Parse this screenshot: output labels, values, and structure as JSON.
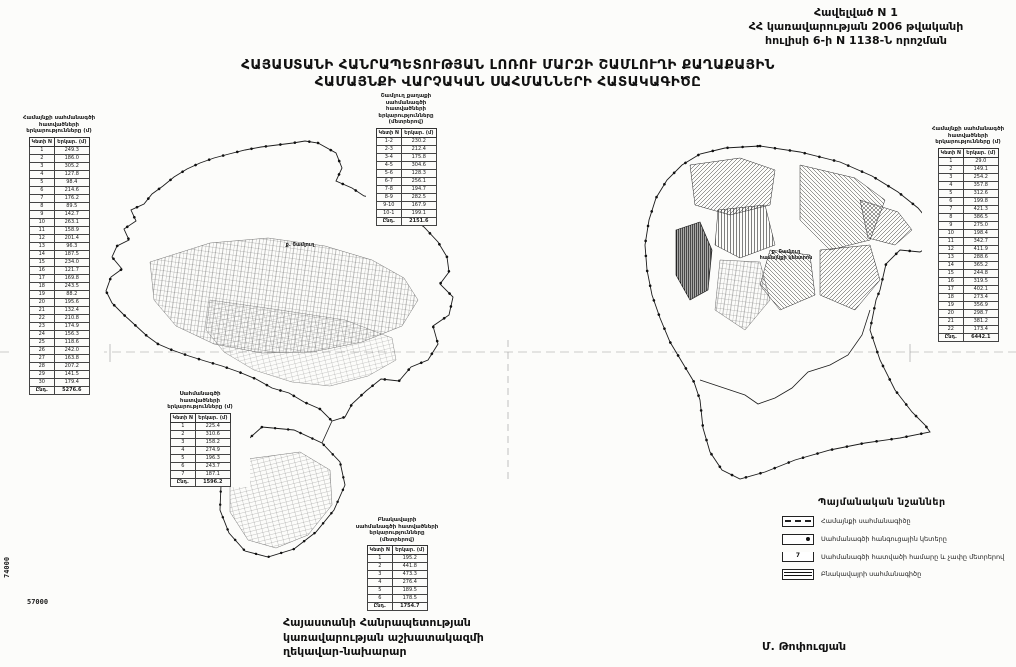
{
  "header": {
    "lines": [
      "Հավելված N 1",
      "ՀՀ կառավարության 2006 թվականի",
      "հուլիսի 6-ի N 1138-Ն որոշման"
    ]
  },
  "title": {
    "line1": "ՀԱՅԱՍՏԱՆԻ ՀԱՆՐԱՊԵՏՈՒԹՅԱՆ ԼՈՌՈՒ ՄԱՐԶԻ ՇԱՄԼՈՒՂԻ ՔԱՂԱՔԱՅԻՆ",
    "line2": "ՀԱՄԱՅՆՔԻ ՎԱՐՉԱԿԱՆ ՍԱՀՄԱՆՆԵՐԻ ՀԱՏԱԿԱԳԻԾԸ"
  },
  "tables": {
    "left": {
      "title_lines": [
        "Համայնքի սահմանագծի",
        "հատվածների",
        "երկարությունները (մ)"
      ],
      "columns": [
        "Կետի N",
        "Երկար. (մ)"
      ],
      "rows": [
        [
          "1",
          "249.3"
        ],
        [
          "2",
          "186.0"
        ],
        [
          "3",
          "305.2"
        ],
        [
          "4",
          "127.8"
        ],
        [
          "5",
          "98.4"
        ],
        [
          "6",
          "214.6"
        ],
        [
          "7",
          "176.2"
        ],
        [
          "8",
          "89.5"
        ],
        [
          "9",
          "142.7"
        ],
        [
          "10",
          "263.1"
        ],
        [
          "11",
          "158.9"
        ],
        [
          "12",
          "201.4"
        ],
        [
          "13",
          "96.3"
        ],
        [
          "14",
          "187.5"
        ],
        [
          "15",
          "234.0"
        ],
        [
          "16",
          "121.7"
        ],
        [
          "17",
          "169.8"
        ],
        [
          "18",
          "243.5"
        ],
        [
          "19",
          "88.2"
        ],
        [
          "20",
          "195.6"
        ],
        [
          "21",
          "132.4"
        ],
        [
          "22",
          "210.8"
        ],
        [
          "23",
          "174.9"
        ],
        [
          "24",
          "156.3"
        ],
        [
          "25",
          "118.6"
        ],
        [
          "26",
          "242.0"
        ],
        [
          "27",
          "163.8"
        ],
        [
          "28",
          "207.2"
        ],
        [
          "29",
          "141.5"
        ],
        [
          "30",
          "179.4"
        ]
      ],
      "total": [
        "Ընդ.",
        "5276.6"
      ]
    },
    "upper_mid": {
      "title_lines": [
        "Շամլուղ քաղաքի",
        "սահմանագծի հատվածների",
        "երկարությունները",
        "(մետրերով)"
      ],
      "columns": [
        "Կետի N",
        "Երկար. (մ)"
      ],
      "rows": [
        [
          "1-2",
          "230.2"
        ],
        [
          "2-3",
          "212.4"
        ],
        [
          "3-4",
          "175.8"
        ],
        [
          "4-5",
          "304.6"
        ],
        [
          "5-6",
          "128.3"
        ],
        [
          "6-7",
          "256.1"
        ],
        [
          "7-8",
          "194.7"
        ],
        [
          "8-9",
          "282.5"
        ],
        [
          "9-10",
          "167.9"
        ],
        [
          "10-1",
          "199.1"
        ]
      ],
      "total": [
        "Ընդ.",
        "2151.6"
      ]
    },
    "mid_left": {
      "title_lines": [
        "Սահմանագծի",
        "հատվածների",
        "երկարությունները (մ)"
      ],
      "columns": [
        "Կետի N",
        "Երկար. (մ)"
      ],
      "rows": [
        [
          "1",
          "225.4"
        ],
        [
          "2",
          "310.6"
        ],
        [
          "3",
          "158.2"
        ],
        [
          "4",
          "274.9"
        ],
        [
          "5",
          "196.3"
        ],
        [
          "6",
          "243.7"
        ],
        [
          "7",
          "187.1"
        ]
      ],
      "total": [
        "Ընդ.",
        "1596.2"
      ]
    },
    "bottom_mid": {
      "title_lines": [
        "Բնակավայրի",
        "սահմանագծի հատվածների",
        "երկարությունները",
        "(մետրերով)"
      ],
      "columns": [
        "Կետի N",
        "Երկար. (մ)"
      ],
      "rows": [
        [
          "1",
          "195.2"
        ],
        [
          "2",
          "441.8"
        ],
        [
          "3",
          "473.3"
        ],
        [
          "4",
          "276.4"
        ],
        [
          "5",
          "189.5"
        ],
        [
          "6",
          "178.5"
        ]
      ],
      "total": [
        "Ընդ.",
        "1754.7"
      ]
    },
    "right": {
      "title_lines": [
        "Համայնքի սահմանագծի",
        "հատվածների",
        "երկարությունները (մ)"
      ],
      "columns": [
        "Կետի N",
        "Երկար. (մ)"
      ],
      "rows": [
        [
          "1",
          "29.0"
        ],
        [
          "2",
          "149.1"
        ],
        [
          "3",
          "254.2"
        ],
        [
          "4",
          "357.8"
        ],
        [
          "5",
          "312.6"
        ],
        [
          "6",
          "199.8"
        ],
        [
          "7",
          "421.3"
        ],
        [
          "8",
          "386.5"
        ],
        [
          "9",
          "275.0"
        ],
        [
          "10",
          "198.4"
        ],
        [
          "11",
          "342.7"
        ],
        [
          "12",
          "411.9"
        ],
        [
          "13",
          "288.6"
        ],
        [
          "14",
          "365.2"
        ],
        [
          "15",
          "244.8"
        ],
        [
          "16",
          "319.5"
        ],
        [
          "17",
          "402.1"
        ],
        [
          "18",
          "273.4"
        ],
        [
          "19",
          "356.9"
        ],
        [
          "20",
          "298.7"
        ],
        [
          "21",
          "381.2"
        ],
        [
          "22",
          "173.4"
        ]
      ],
      "total": [
        "Ընդ.",
        "6442.1"
      ]
    }
  },
  "legend": {
    "title": "Պայմանական նշաններ",
    "items": [
      {
        "symbol": "community-boundary",
        "value": "",
        "label": "Համայնքի սահմանագիծը"
      },
      {
        "symbol": "node-points",
        "value": "",
        "label": "Սահմանագծի հանգուցային կետերը"
      },
      {
        "symbol": "segment-number",
        "value": "7",
        "label": "Սահմանագծի հատվածի համարը և չափը մետրերով"
      },
      {
        "symbol": "settlement-boundary",
        "value": "",
        "label": "Բնակավայրի սահմանագիծը"
      }
    ]
  },
  "signature": {
    "lines": [
      "Հայաստանի Հանրապետության",
      "կառավարության աշխատակազմի",
      "ղեկավար-նախարար"
    ],
    "name": "Մ. Թոփուզյան"
  },
  "map_labels": {
    "left_map": "ք. Շամլուղ",
    "right_map_line1": "ք. Շամլուղ",
    "right_map_line2": "համայնքի կենտրոն"
  },
  "grid": {
    "vertical_label": "74000",
    "horizontal_label": "57000"
  }
}
